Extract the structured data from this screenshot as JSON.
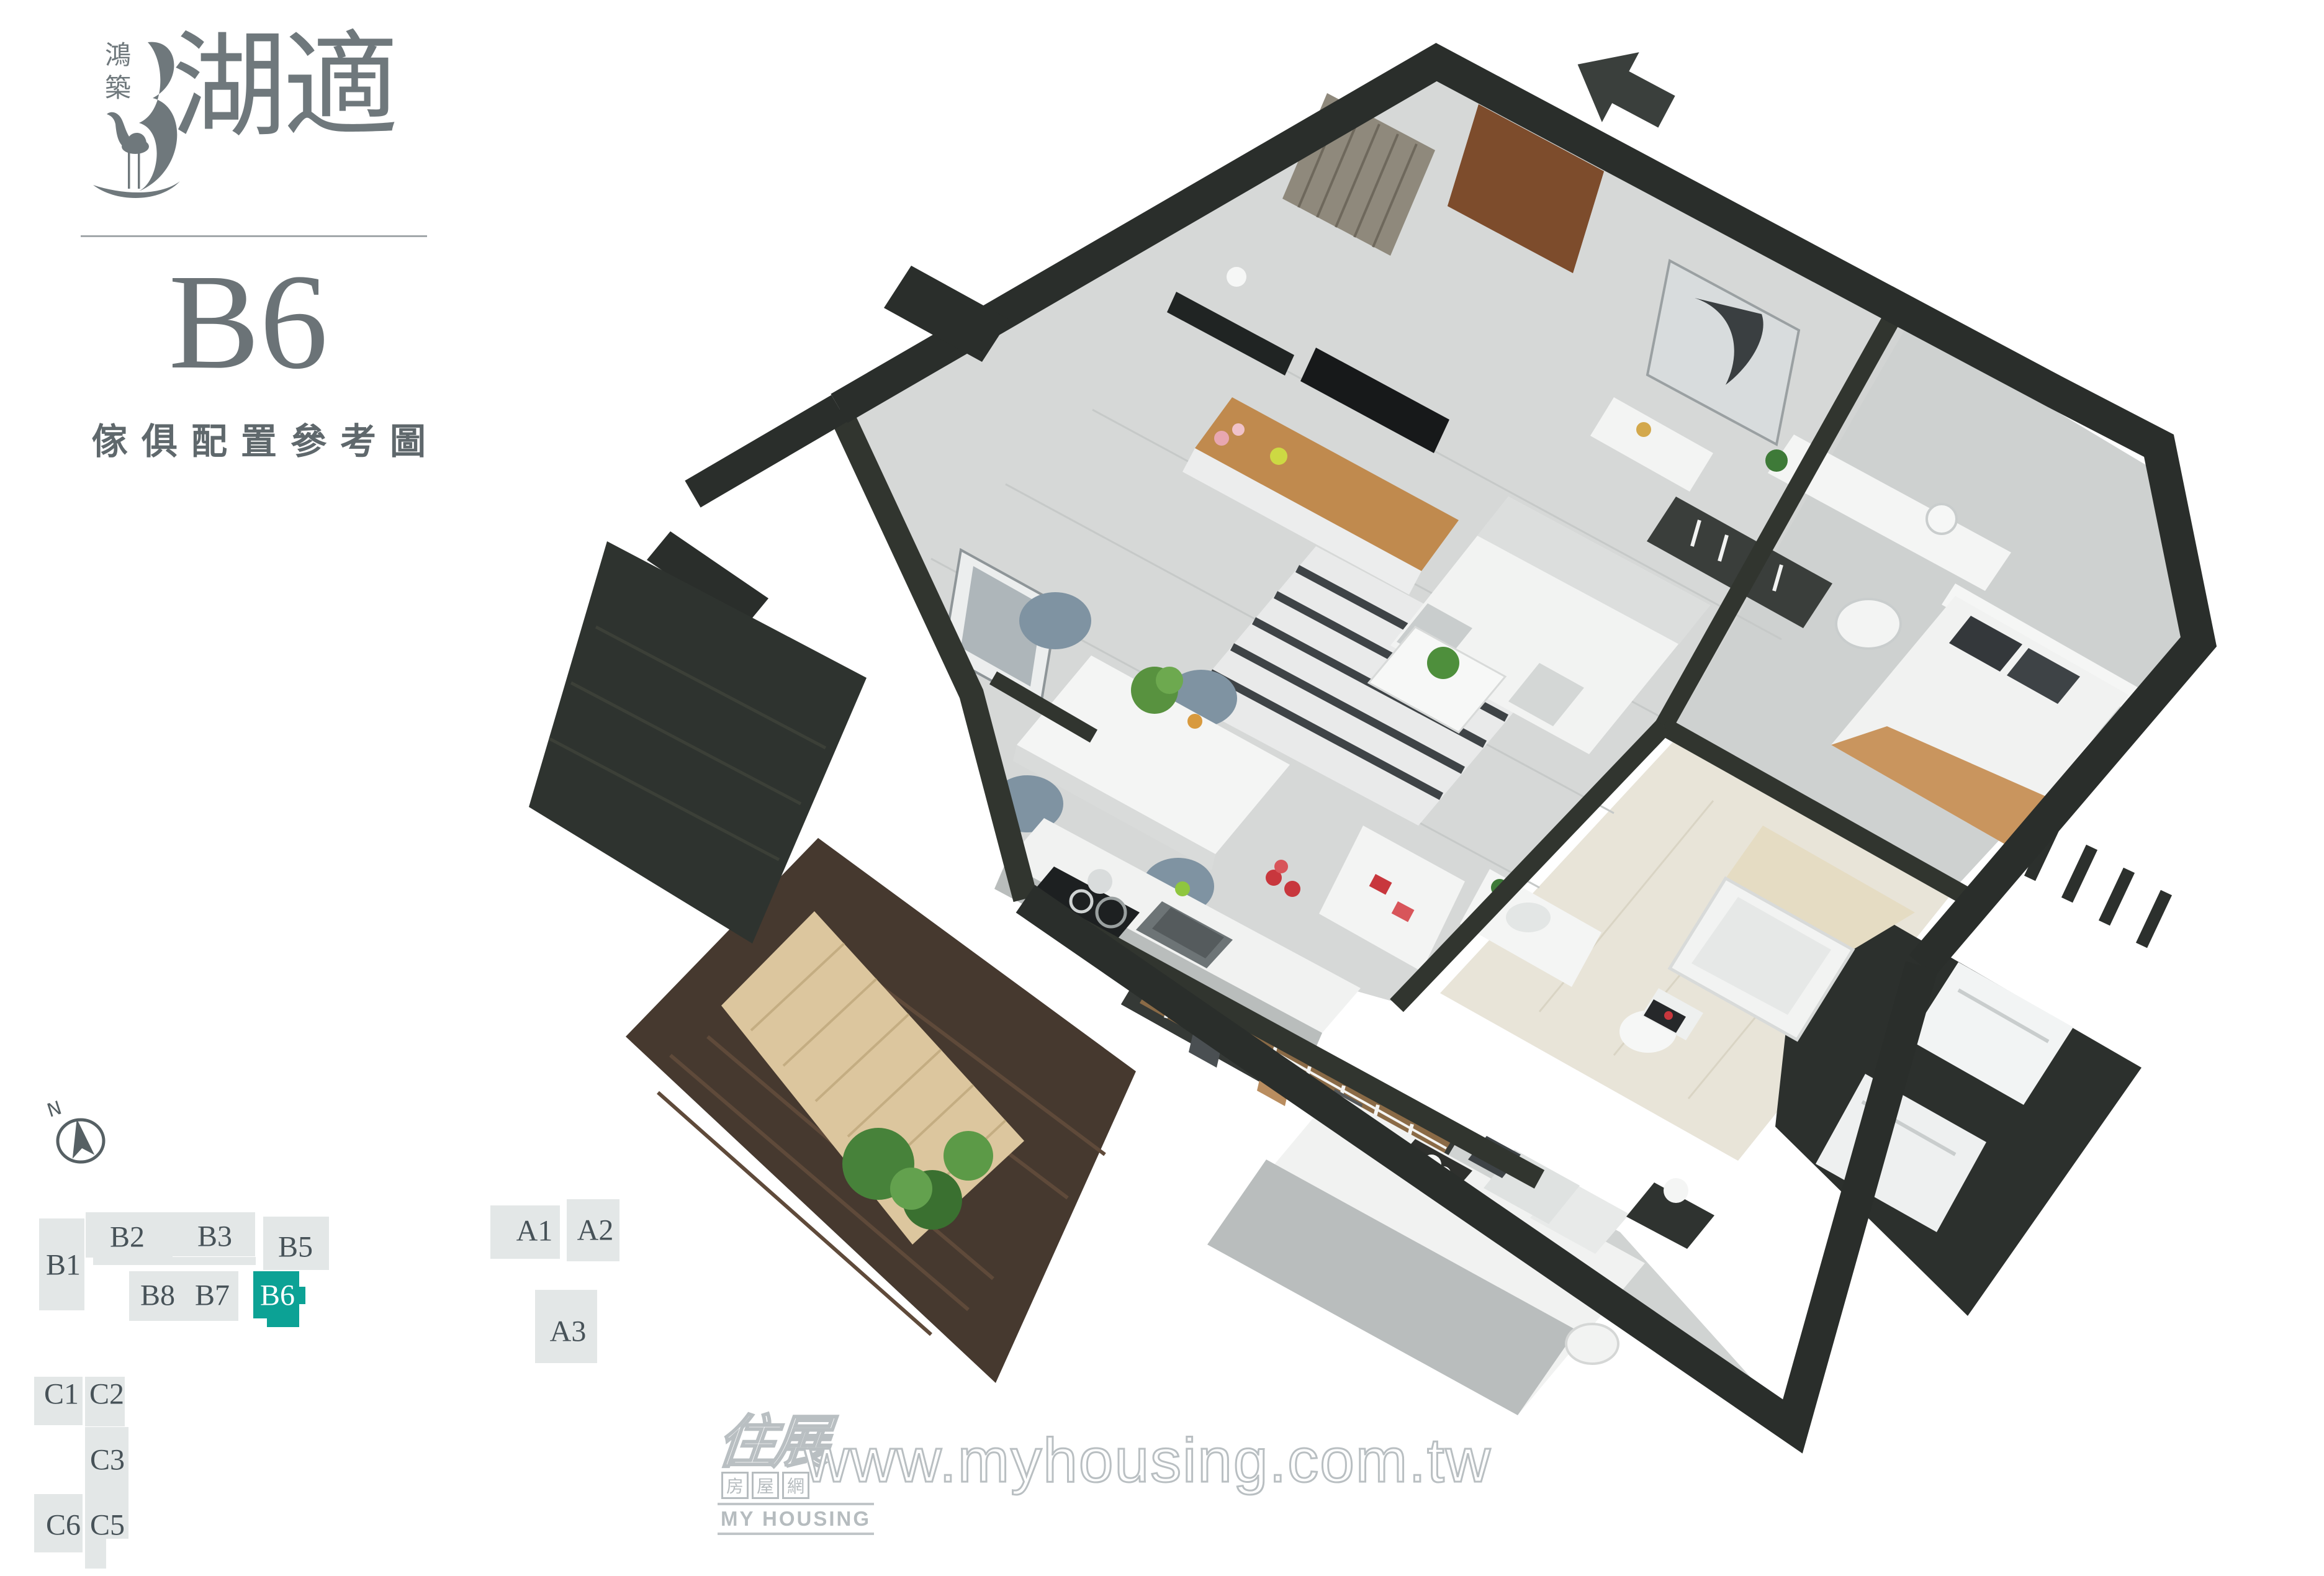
{
  "branding": {
    "developer": "鴻築",
    "project": "湖適",
    "crane_icon": "crane-logo"
  },
  "header": {
    "unit": "B6",
    "subtitle": "傢俱配置參考圖"
  },
  "compass": {
    "north_label": "N"
  },
  "sitemap": {
    "highlighted_unit": "B6",
    "colors": {
      "block": "#e3e7e7",
      "highlight": "#0ca295",
      "label": "#475258",
      "highlight_label": "#ffffff"
    },
    "units": [
      {
        "id": "B1",
        "label": "B1",
        "highlighted": false
      },
      {
        "id": "B2",
        "label": "B2",
        "highlighted": false
      },
      {
        "id": "B3",
        "label": "B3",
        "highlighted": false
      },
      {
        "id": "B5",
        "label": "B5",
        "highlighted": false
      },
      {
        "id": "B8",
        "label": "B8",
        "highlighted": false
      },
      {
        "id": "B7",
        "label": "B7",
        "highlighted": false
      },
      {
        "id": "B6",
        "label": "B6",
        "highlighted": true
      },
      {
        "id": "A1",
        "label": "A1",
        "highlighted": false
      },
      {
        "id": "A2",
        "label": "A2",
        "highlighted": false
      },
      {
        "id": "A3",
        "label": "A3",
        "highlighted": false
      },
      {
        "id": "C1",
        "label": "C1",
        "highlighted": false
      },
      {
        "id": "C2",
        "label": "C2",
        "highlighted": false
      },
      {
        "id": "C3",
        "label": "C3",
        "highlighted": false
      },
      {
        "id": "C6",
        "label": "C6",
        "highlighted": false
      },
      {
        "id": "C5",
        "label": "C5",
        "highlighted": false
      }
    ]
  },
  "floorplan": {
    "view": "isometric furnished 3D floor plan of unit B6",
    "entrance_arrow": "points to entry door at top",
    "colors": {
      "wall": "#2a2e2b",
      "wall_inner": "#31352f",
      "floor": "#d6d8d7",
      "floor_bedroom": "#ced1d0",
      "bath_tile": "#e8e4d8",
      "deck_wood": "#dcc69e",
      "brick_planter": "#46392f",
      "entry_door": "#7d4c2c",
      "tv_console_wood": "#c08a4e",
      "dining_chair": "#7f93a2",
      "sofa": "#f2f3f2",
      "rug_stripe": "#3e4346",
      "plant_green": "#4e8f3c",
      "bed_blanket": "#b9bdbd",
      "bed2_throw": "#c9955e",
      "wardrobe_wood": "#8a6a46"
    }
  },
  "watermark": {
    "logo_main": "住展",
    "logo_boxes": [
      "房",
      "屋",
      "網"
    ],
    "logo_en": "MY HOUSING",
    "url": "www.myhousing.com.tw"
  }
}
